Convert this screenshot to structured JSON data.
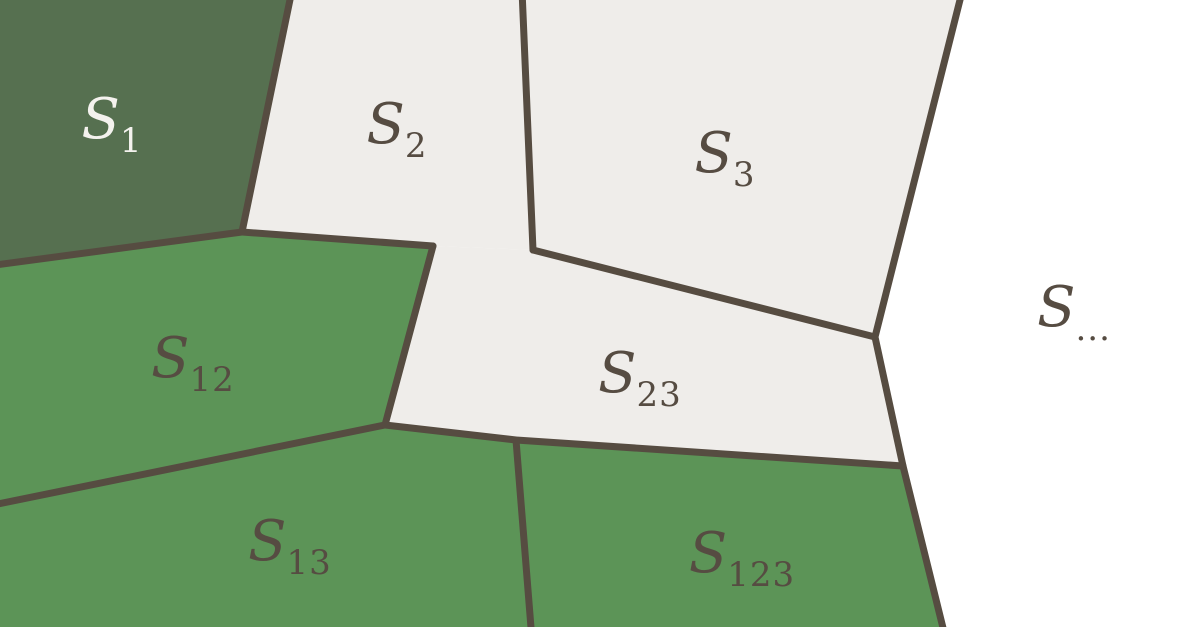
{
  "figure": {
    "width": 1200,
    "height": 627,
    "background": "#ffffff",
    "border": {
      "color": "#564c41",
      "width": 7
    },
    "colors": {
      "dark_green": "#567050",
      "green": "#5c9457",
      "light_gray": "#efedea",
      "white": "#ffffff",
      "label_dark": "#564c42",
      "label_light": "#f4f2ee"
    },
    "regions": [
      {
        "id": "s1",
        "label_main": "S",
        "label_sub": "1",
        "fill_key": "dark_green",
        "label_color_key": "label_light",
        "label_x": 112,
        "label_y": 138,
        "points": [
          [
            0,
            0
          ],
          [
            290,
            0
          ],
          [
            242,
            232
          ],
          [
            0,
            265
          ]
        ]
      },
      {
        "id": "s2",
        "label_main": "S",
        "label_sub": "2",
        "fill_key": "light_gray",
        "label_color_key": "label_dark",
        "label_x": 397,
        "label_y": 143,
        "points": [
          [
            290,
            0
          ],
          [
            523,
            0
          ],
          [
            533,
            250
          ],
          [
            433,
            246
          ],
          [
            242,
            232
          ]
        ]
      },
      {
        "id": "s3",
        "label_main": "S",
        "label_sub": "3",
        "fill_key": "light_gray",
        "label_color_key": "label_dark",
        "label_x": 725,
        "label_y": 172,
        "points": [
          [
            523,
            0
          ],
          [
            960,
            0
          ],
          [
            875,
            337
          ],
          [
            533,
            250
          ]
        ]
      },
      {
        "id": "s12",
        "label_main": "S",
        "label_sub": "12",
        "fill_key": "green",
        "label_color_key": "label_dark",
        "label_x": 193,
        "label_y": 377,
        "points": [
          [
            0,
            265
          ],
          [
            242,
            232
          ],
          [
            433,
            246
          ],
          [
            385,
            425
          ],
          [
            0,
            503
          ]
        ]
      },
      {
        "id": "s23",
        "label_main": "S",
        "label_sub": "23",
        "fill_key": "light_gray",
        "label_color_key": "label_dark",
        "label_x": 640,
        "label_y": 392,
        "points": [
          [
            433,
            246
          ],
          [
            533,
            250
          ],
          [
            875,
            337
          ],
          [
            903,
            466
          ],
          [
            516,
            440
          ],
          [
            385,
            425
          ]
        ]
      },
      {
        "id": "s13",
        "label_main": "S",
        "label_sub": "13",
        "fill_key": "green",
        "label_color_key": "label_dark",
        "label_x": 290,
        "label_y": 560,
        "points": [
          [
            0,
            503
          ],
          [
            385,
            425
          ],
          [
            516,
            440
          ],
          [
            531,
            627
          ],
          [
            0,
            627
          ]
        ]
      },
      {
        "id": "s123",
        "label_main": "S",
        "label_sub": "123",
        "fill_key": "green",
        "label_color_key": "label_dark",
        "label_x": 742,
        "label_y": 572,
        "points": [
          [
            516,
            440
          ],
          [
            903,
            466
          ],
          [
            943,
            627
          ],
          [
            531,
            627
          ]
        ]
      },
      {
        "id": "srest",
        "label_main": "S",
        "label_sub": "...",
        "fill_key": "white",
        "label_color_key": "label_dark",
        "label_x": 1074,
        "label_y": 326,
        "points": [
          [
            960,
            0
          ],
          [
            1200,
            0
          ],
          [
            1200,
            627
          ],
          [
            943,
            627
          ],
          [
            903,
            466
          ],
          [
            875,
            337
          ]
        ]
      }
    ],
    "borders": [
      {
        "id": "s1-s2-s12",
        "points": [
          [
            292,
            -10
          ],
          [
            242,
            232
          ],
          [
            -12,
            266
          ]
        ]
      },
      {
        "id": "s2-s12",
        "points": [
          [
            242,
            232
          ],
          [
            433,
            246
          ]
        ]
      },
      {
        "id": "s2-s3",
        "points": [
          [
            522,
            -10
          ],
          [
            533,
            250
          ]
        ]
      },
      {
        "id": "s3-s23",
        "points": [
          [
            533,
            250
          ],
          [
            875,
            337
          ]
        ]
      },
      {
        "id": "outer-right",
        "points": [
          [
            963,
            -12
          ],
          [
            875,
            337
          ],
          [
            903,
            466
          ],
          [
            946,
            640
          ]
        ]
      },
      {
        "id": "s12-s23",
        "points": [
          [
            433,
            246
          ],
          [
            385,
            425
          ]
        ]
      },
      {
        "id": "s12-s13",
        "points": [
          [
            385,
            425
          ],
          [
            -12,
            506
          ]
        ]
      },
      {
        "id": "s23-bottom",
        "points": [
          [
            385,
            425
          ],
          [
            516,
            440
          ],
          [
            903,
            466
          ]
        ]
      },
      {
        "id": "s13-s123",
        "points": [
          [
            516,
            440
          ],
          [
            532,
            640
          ]
        ]
      }
    ]
  }
}
